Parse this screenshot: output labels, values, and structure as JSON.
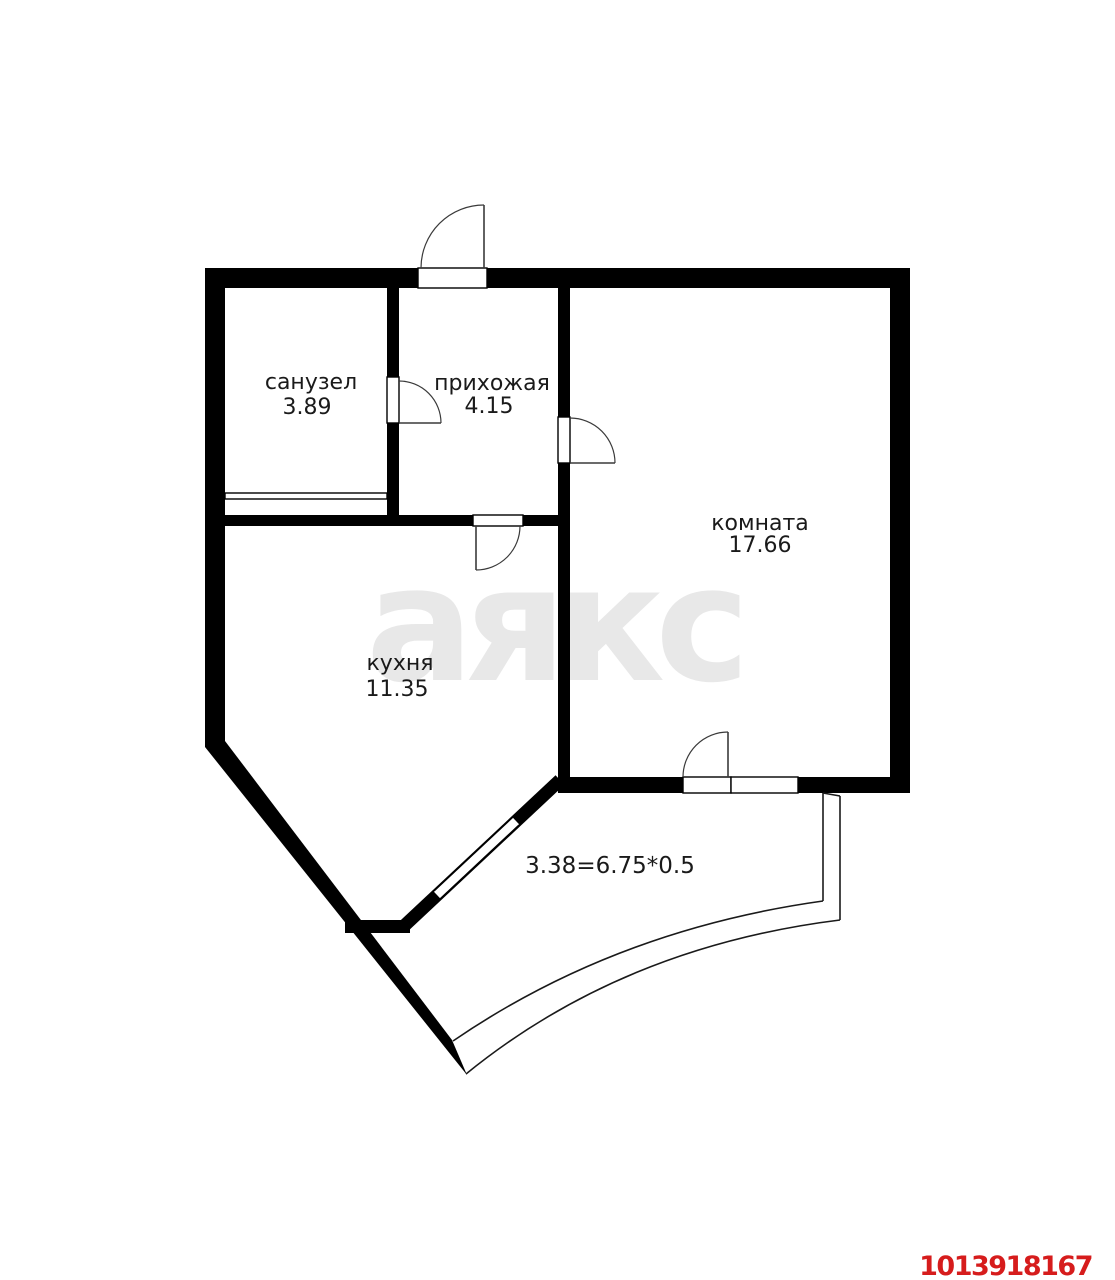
{
  "plan": {
    "background_color": "#ffffff",
    "wall_color": "#000000",
    "label_color": "#1a1a1a",
    "watermark": {
      "text": "аякс",
      "color": "#e8e8e8"
    },
    "listing_id": {
      "text": "1013918167",
      "color": "#d61c1c"
    },
    "rooms": [
      {
        "name": "санузел",
        "area": "3.89"
      },
      {
        "name": "прихожая",
        "area": "4.15"
      },
      {
        "name": "комната",
        "area": "17.66"
      },
      {
        "name": "кухня",
        "area": "11.35"
      }
    ],
    "balcony": {
      "dimension_formula": "3.38=6.75*0.5"
    }
  }
}
